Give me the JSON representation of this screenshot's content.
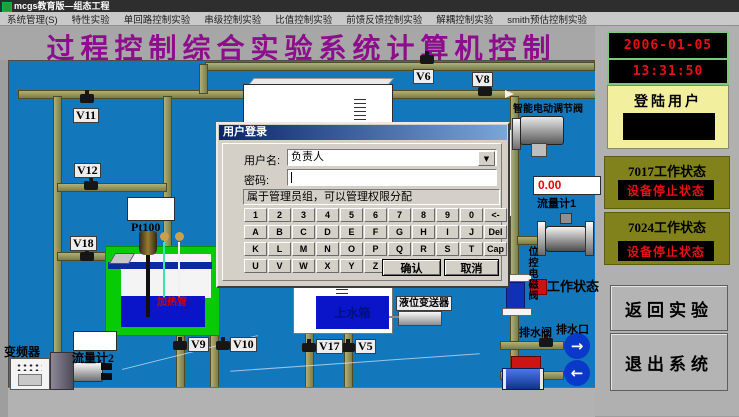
{
  "window": {
    "title": "mcgs教育版—组态工程"
  },
  "menu": {
    "items": [
      "系统管理(S)",
      "特性实验",
      "单回路控制实验",
      "串级控制实验",
      "比值控制实验",
      "前馈反馈控制实验",
      "解耦控制实验",
      "smith预估控制实验"
    ]
  },
  "banner": {
    "title": "过程控制综合实验系统计算机控制"
  },
  "sidebar": {
    "date": "2006-01-05",
    "time": "13:31:50",
    "login_label": "登陆用户",
    "s7017_title": "7017工作状态",
    "s7017_status": "设备停止状态",
    "s7024_title": "7024工作状态",
    "s7024_status": "设备停止状态",
    "return_label": "返回实验",
    "exit_label": "退出系统"
  },
  "dialog": {
    "title": "用户登录",
    "username_label": "用户名:",
    "username_value": "负责人",
    "password_label": "密码:",
    "password_value": "",
    "info": "属于管理员组，可以管理权限分配",
    "keys_row1": [
      "1",
      "2",
      "3",
      "4",
      "5",
      "6",
      "7",
      "8",
      "9",
      "0",
      "<-"
    ],
    "keys_row2": [
      "A",
      "B",
      "C",
      "D",
      "E",
      "F",
      "G",
      "H",
      "I",
      "J",
      "Del"
    ],
    "keys_row3": [
      "K",
      "L",
      "M",
      "N",
      "O",
      "P",
      "Q",
      "R",
      "S",
      "T",
      "Cap"
    ],
    "keys_row4": [
      "U",
      "V",
      "W",
      "X",
      "Y",
      "Z"
    ],
    "confirm_label": "确认",
    "cancel_label": "取消"
  },
  "diagram": {
    "valves": {
      "v11": "V11",
      "v12": "V12",
      "v18": "V18",
      "v6": "V6",
      "v8": "V8",
      "v9": "V9",
      "v10": "V10",
      "v17": "V17",
      "v5": "V5"
    },
    "labels": {
      "pt100": "Pt100",
      "flow1": "流量计1",
      "flow1_value": "0.00",
      "flow2": "流量计2",
      "inverter": "变频器",
      "smart_valve": "智能电动调节阀",
      "level_tx": "液位变送器",
      "heater": "加热管",
      "upper_tank": "上水箱",
      "drain_valve": "排水阀",
      "drain_outlet": "排水口",
      "onoff_valve": "位控电磁阀",
      "work_status": "工作状态"
    }
  },
  "icons": {
    "arrow_right": "→",
    "arrow_left": "←",
    "combo_down": "▼"
  },
  "colors": {
    "diagram_bg": "#1377bb",
    "pipe": "#8e8e57",
    "banner_text": "#8b0f8b",
    "alarm_red": "#e81111",
    "olive_panel": "#82821c",
    "login_bg": "#f2ef9e",
    "led_border_green": "#7cc87c",
    "tank_green": "#07cb07",
    "water_blue": "#0a14c8"
  }
}
